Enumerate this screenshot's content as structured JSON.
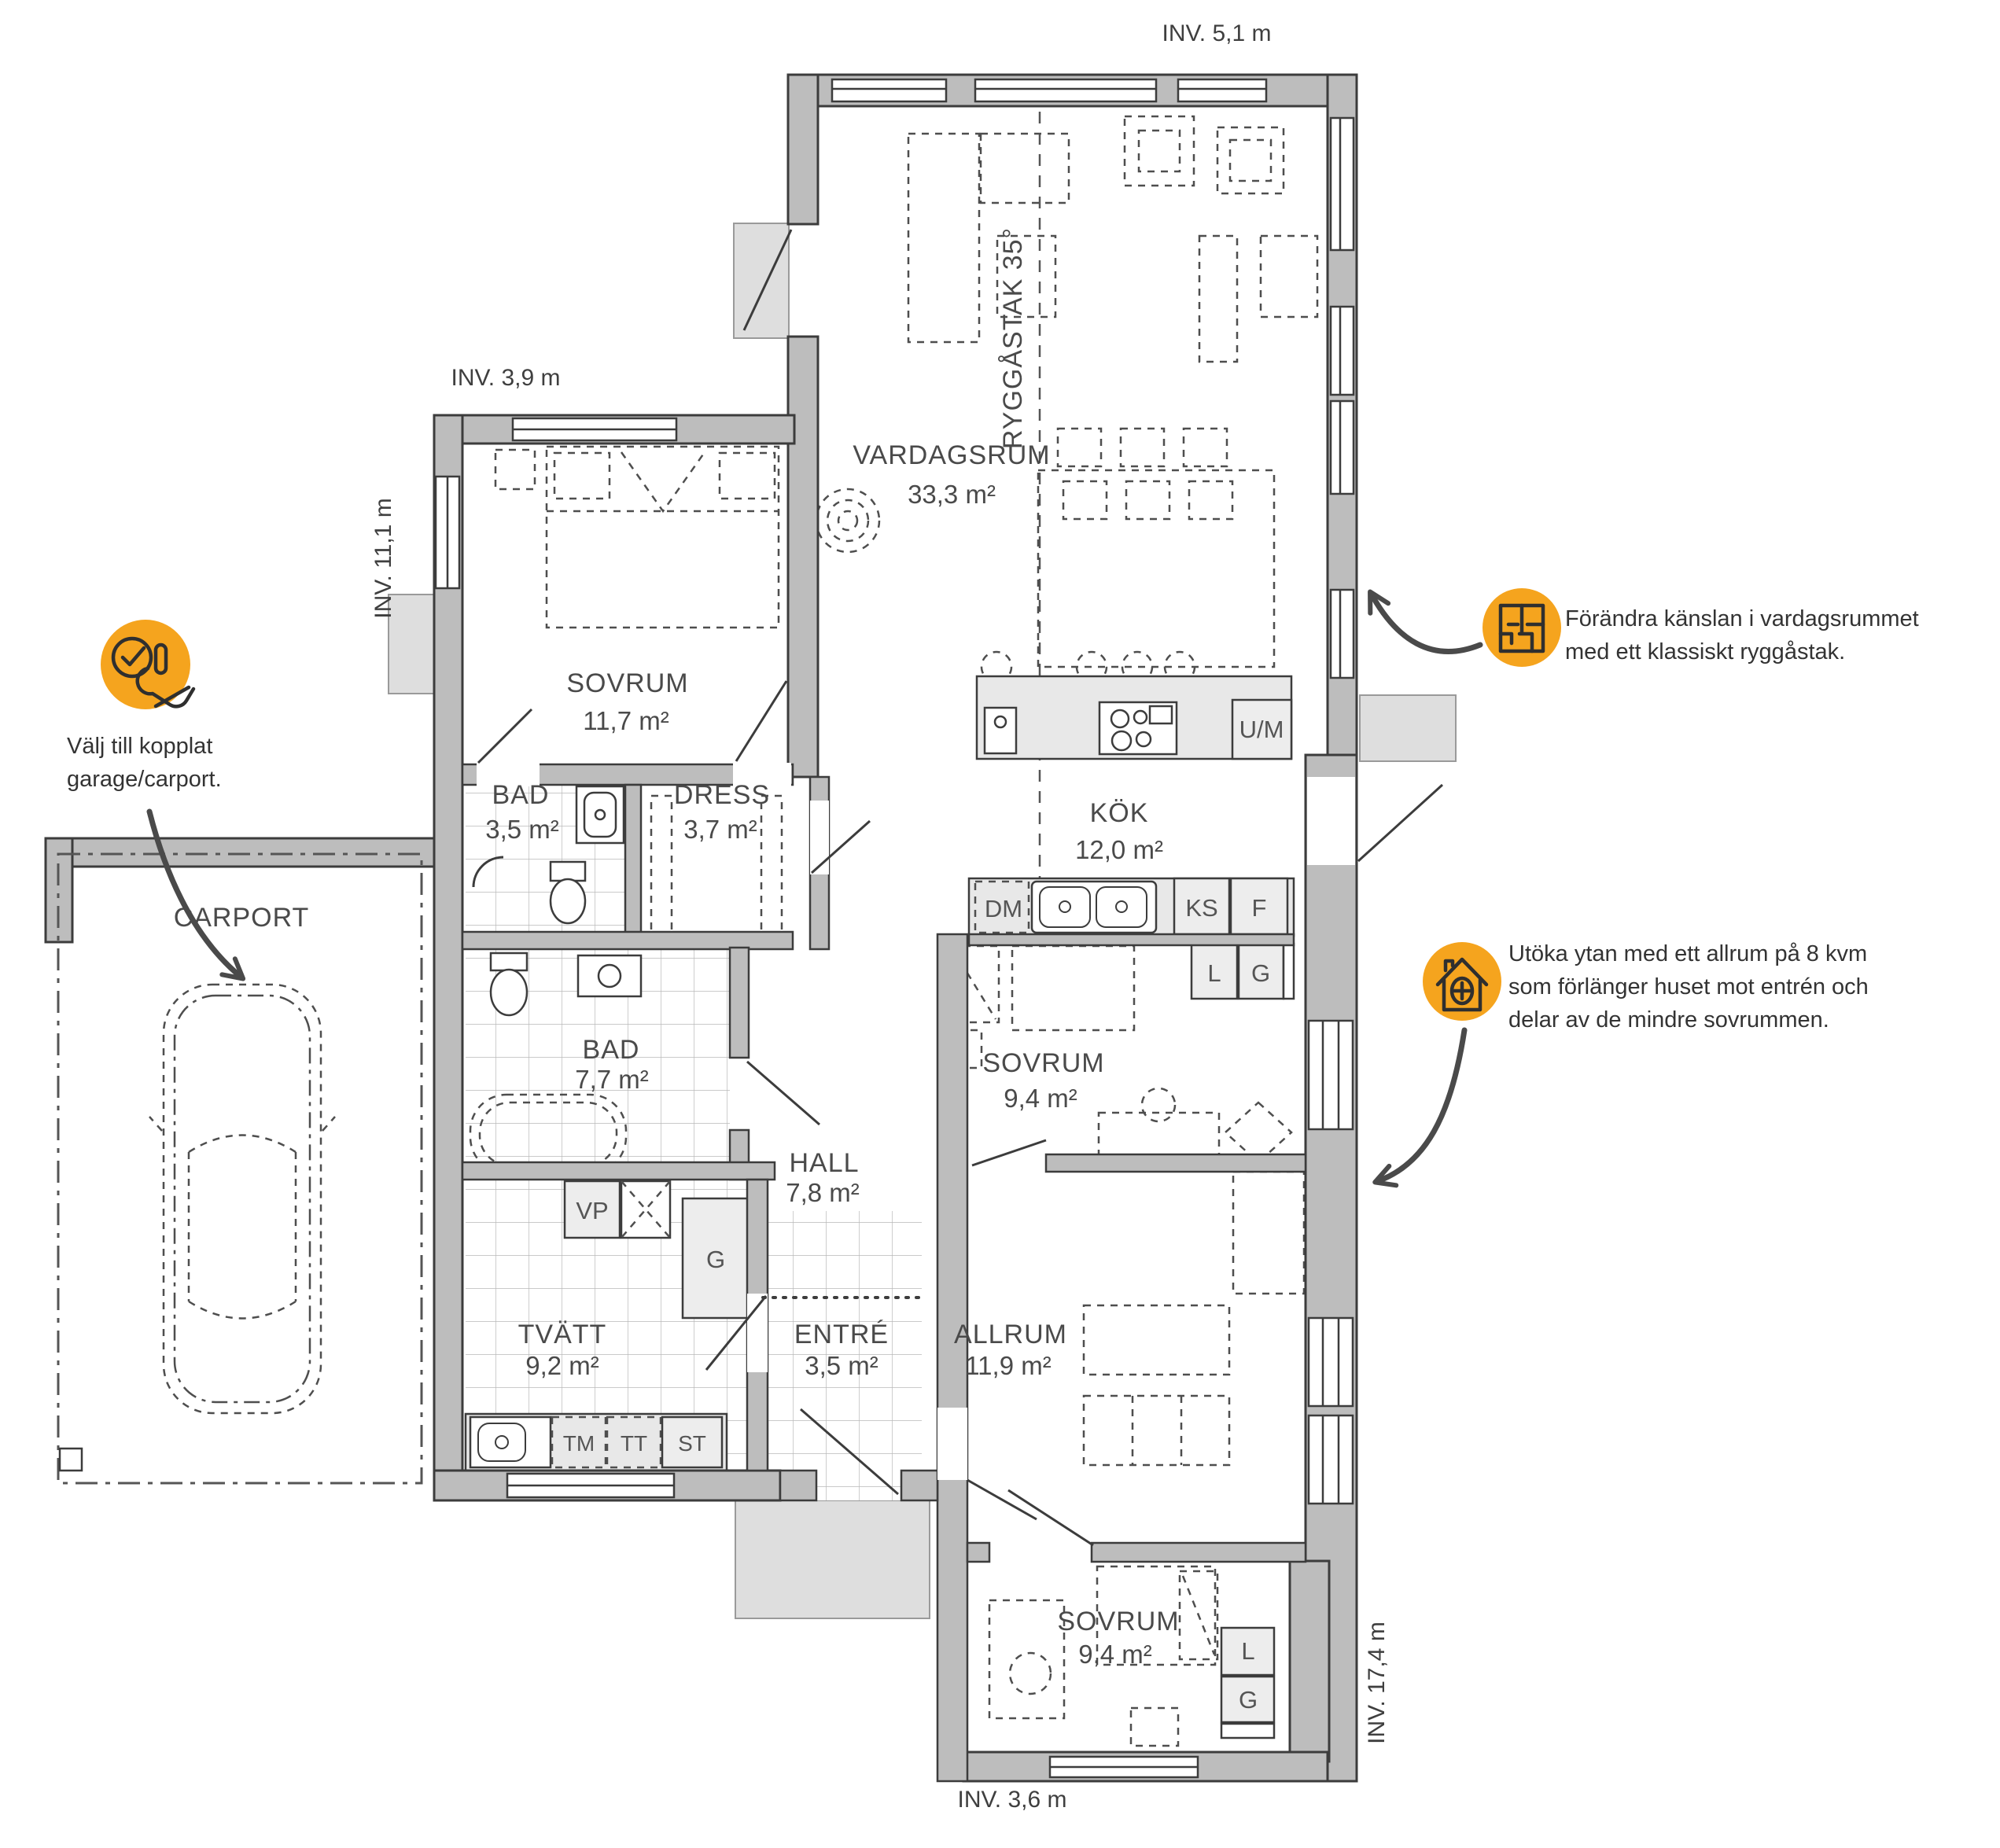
{
  "dimensions": {
    "top": "INV. 5,1 m",
    "wing_top": "INV. 3,9 m",
    "wing_left": "INV. 11,1 m",
    "right": "INV. 17,4 m",
    "bottom": "INV. 3,6 m"
  },
  "ridge_label": "RYGGÅSTAK 35°",
  "rooms": {
    "vardagsrum": {
      "name": "VARDAGSRUM",
      "area": "33,3 m²"
    },
    "sovrum1": {
      "name": "SOVRUM",
      "area": "11,7 m²"
    },
    "bad1": {
      "name": "BAD",
      "area": "3,5 m²"
    },
    "dress": {
      "name": "DRESS",
      "area": "3,7 m²"
    },
    "kok": {
      "name": "KÖK",
      "area": "12,0 m²"
    },
    "sovrum2": {
      "name": "SOVRUM",
      "area": "9,4 m²"
    },
    "bad2": {
      "name": "BAD",
      "area": "7,7 m²"
    },
    "hall": {
      "name": "HALL",
      "area": "7,8 m²"
    },
    "tvatt": {
      "name": "TVÄTT",
      "area": "9,2 m²"
    },
    "entre": {
      "name": "ENTRÉ",
      "area": "3,5 m²"
    },
    "allrum": {
      "name": "ALLRUM",
      "area": "11,9 m²"
    },
    "sovrum3": {
      "name": "SOVRUM",
      "area": "9,4 m²"
    },
    "carport": {
      "name": "CARPORT"
    }
  },
  "fixtures": {
    "um": "U/M",
    "dm": "DM",
    "ks": "KS",
    "f": "F",
    "l": "L",
    "g": "G",
    "vp": "VP",
    "tm": "TM",
    "tt": "TT",
    "st": "ST"
  },
  "annotations": {
    "carport_note": {
      "icon": "hand-check-icon",
      "lines": [
        "Välj till kopplat",
        "garage/carport."
      ]
    },
    "ridge_note": {
      "icon": "floorplan-icon",
      "lines": [
        "Förändra känslan i vardagsrummet",
        "med ett klassiskt ryggåstak."
      ]
    },
    "allrum_note": {
      "icon": "house-plus-icon",
      "lines": [
        "Utöka ytan med ett allrum på 8 kvm",
        "som förlänger huset mot entrén och",
        "delar av de mindre sovrummen."
      ]
    }
  },
  "colors": {
    "accent_orange": "#F5A41E",
    "wall_gray": "#BDBDBD",
    "outline": "#3C3C3C",
    "text": "#4A4A4A"
  }
}
